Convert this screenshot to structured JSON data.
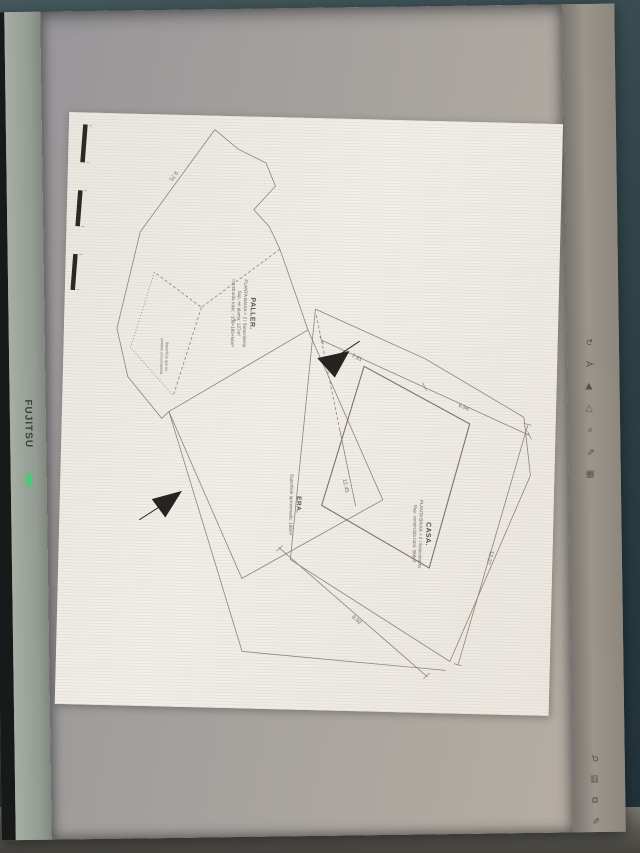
{
  "device": {
    "brand": "FUJITSU"
  },
  "plan": {
    "parcels": [
      {
        "id": "paller",
        "title": "PALLER.",
        "lines": [
          "PLANTA BAIXA + 2 i Sotacoberta",
          "Sup. en planta: 127m²",
          "construïda total: ~108+160+54m²"
        ]
      },
      {
        "id": "casa",
        "title": "CASA.",
        "lines": [
          "PLANTA BAIXA + 2 i Sotacoberta",
          "Sup. construïda total: 368m²"
        ]
      },
      {
        "id": "era",
        "title": "ERA.",
        "lines": [
          "Superficie aproximada: 166m²"
        ]
      }
    ],
    "note_line1": "Superfície que no",
    "note_line2": "pertany a la propietat",
    "dimensions": [
      {
        "label": "9.75"
      },
      {
        "label": "7.81"
      },
      {
        "label": "6.94"
      },
      {
        "label": "12.27"
      },
      {
        "label": "12.45"
      },
      {
        "label": "8.92"
      }
    ]
  },
  "toolbar": {
    "top_icons": [
      {
        "name": "rotate-icon",
        "glyph": "↻"
      },
      {
        "name": "text-tool-icon",
        "glyph": "Ā"
      },
      {
        "name": "back-triangle-icon",
        "glyph": "◀"
      },
      {
        "name": "forward-triangle-icon",
        "glyph": "◁"
      },
      {
        "name": "freehand-icon",
        "glyph": "≈"
      },
      {
        "name": "pencil-icon",
        "glyph": "✎"
      },
      {
        "name": "grid-icon",
        "glyph": "▦"
      }
    ],
    "bottom_icons": [
      {
        "name": "zoom-icon",
        "glyph": "⚲"
      },
      {
        "name": "image-icon",
        "glyph": "▤"
      },
      {
        "name": "copy-icon",
        "glyph": "⧉"
      },
      {
        "name": "edit-icon",
        "glyph": "✎"
      }
    ]
  },
  "status": {
    "power_led": "on"
  }
}
